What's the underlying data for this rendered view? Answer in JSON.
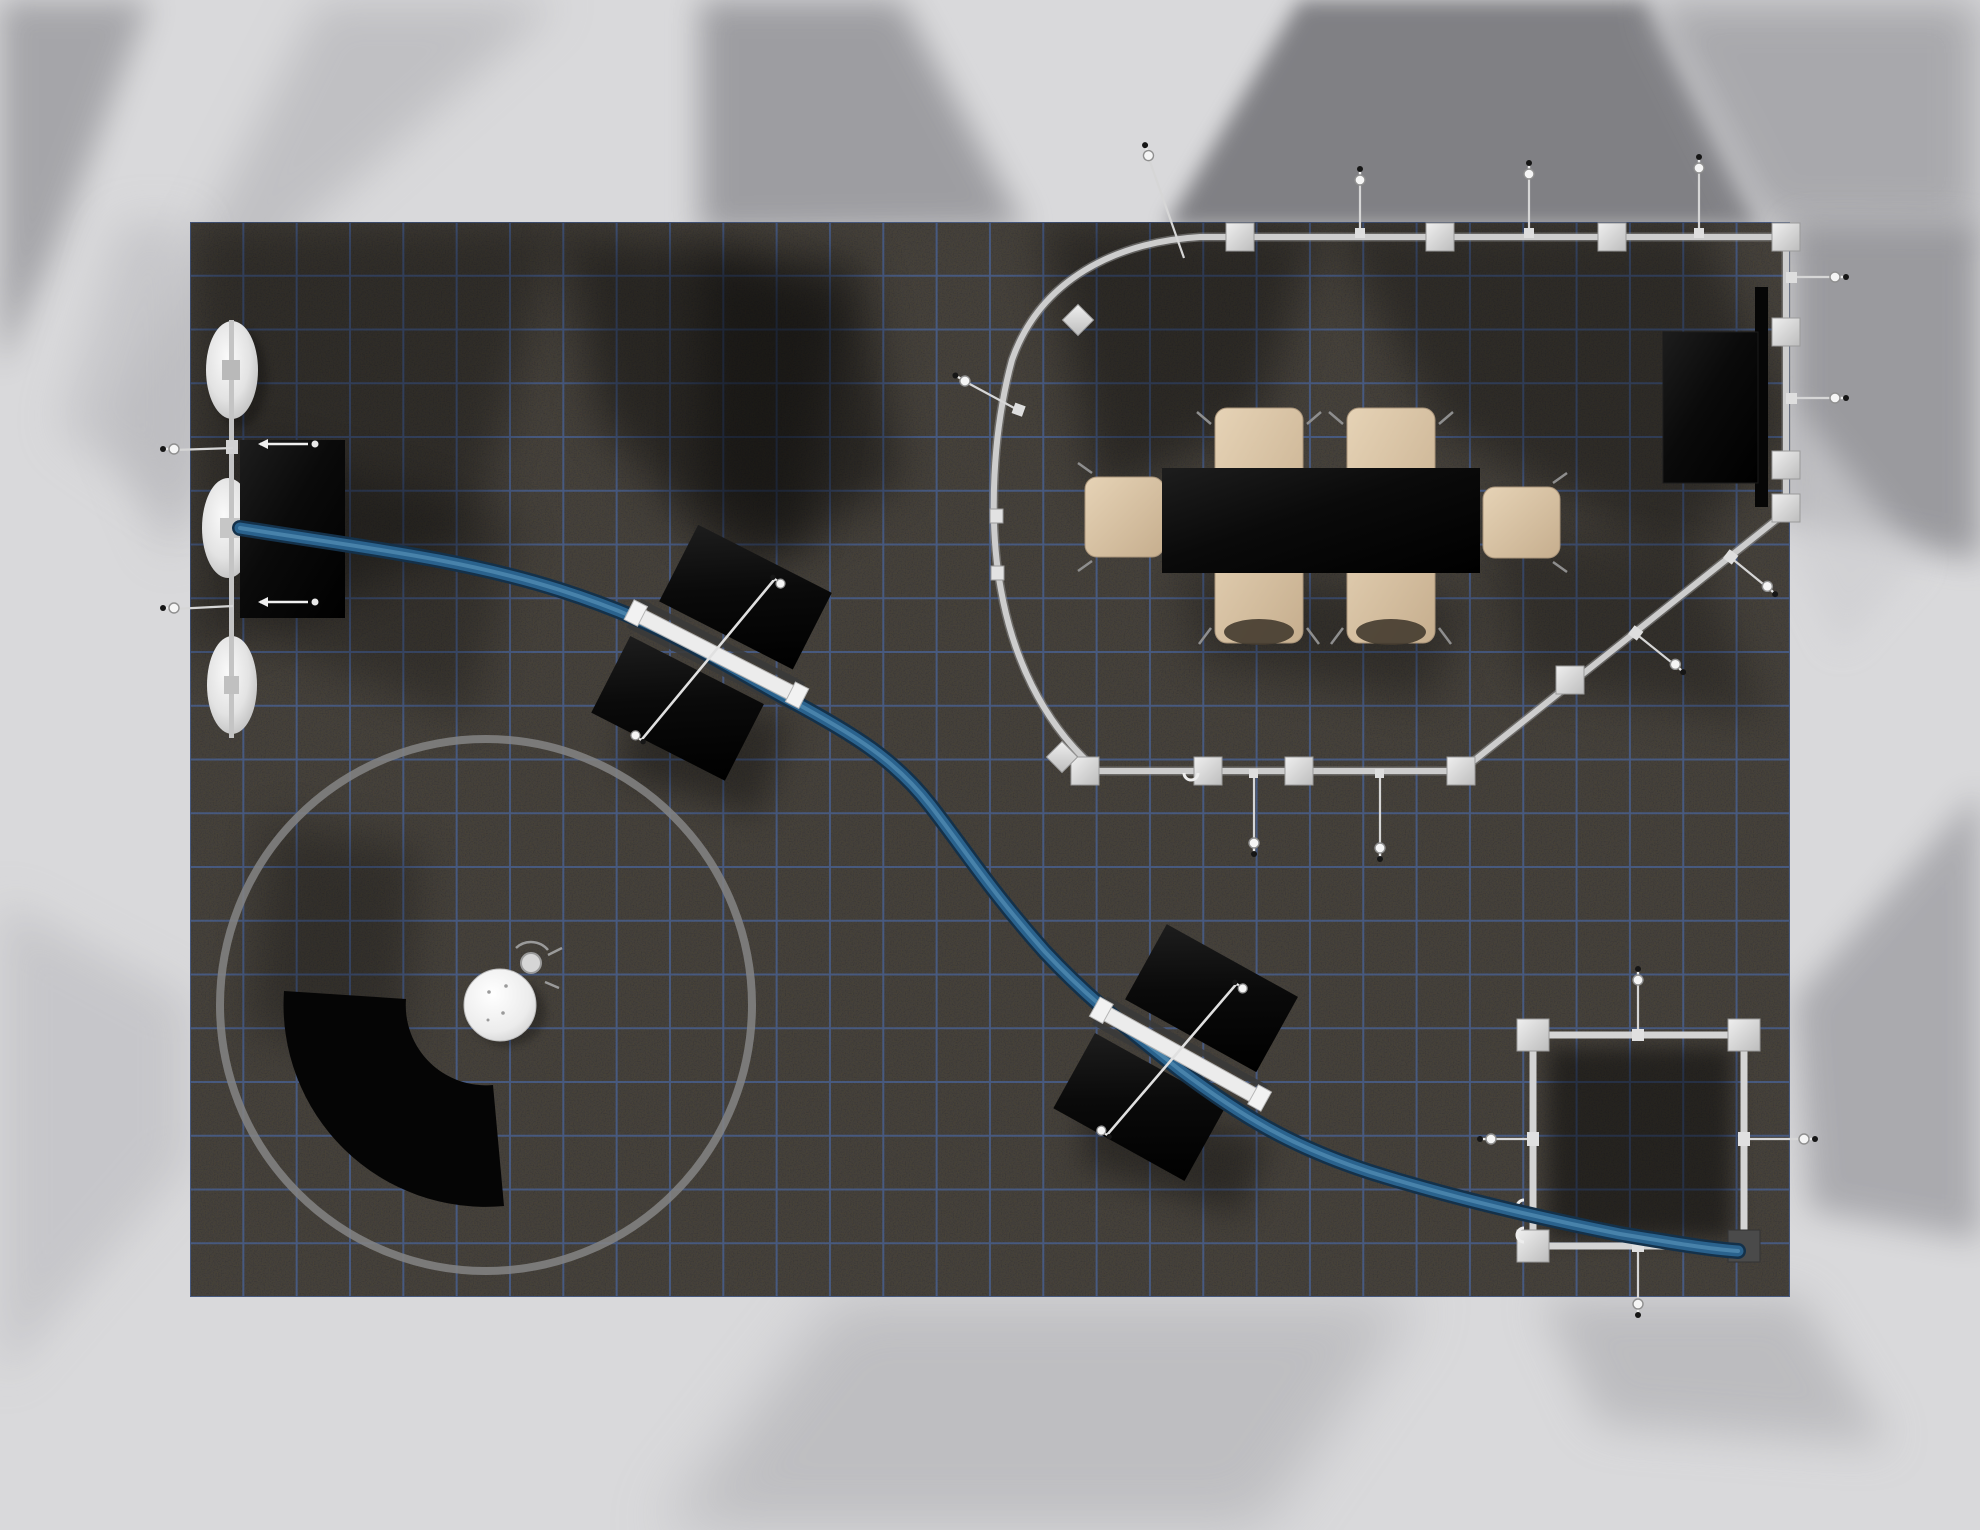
{
  "scene": {
    "label": "exhibit-booth-floorplan-render-top-view",
    "colors": {
      "bg": "#dcdcde",
      "bg_shadow_dark": "#7c7c80",
      "bg_shadow_mid": "#a0a0a4",
      "carpet": "#4e4943",
      "grid_line": "#4a6fb8",
      "frame_tube": "#cccccc",
      "frame_connector": "#d8d8d8",
      "tube_dark": "#14314a",
      "tube_mid": "#2a628d",
      "tube_light": "#4b86ad",
      "panel_black": "#0a0a0a",
      "chair_beige": "#d8c3a5",
      "disc_white": "#f2f2f2",
      "ring_gray": "#858585",
      "table_black": "#0d0d0d"
    },
    "objects": {
      "carpet": {
        "label": "dark booth carpet with blue layout grid"
      },
      "disc_tower": {
        "label": "three stacked white disc canopies on pole"
      },
      "graphic_panel": {
        "label": "black rectangular graphic panel"
      },
      "serpentine_tube": {
        "label": "blue serpentine tube running across booth"
      },
      "workstation_1": {
        "label": "angled double black panel workstation"
      },
      "workstation_2": {
        "label": "angled double black panel workstation"
      },
      "circle_rug": {
        "label": "large gray circle outline zone"
      },
      "fan_counter": {
        "label": "black quarter-arc curved counter"
      },
      "round_table": {
        "label": "small round white table with stool"
      },
      "conference_frame": {
        "label": "curved perimeter frame around meeting area"
      },
      "conference_table": {
        "label": "black rectangular conference table"
      },
      "chairs": {
        "label": "six beige conference chairs",
        "count": 6
      },
      "tv_screen": {
        "label": "wall mounted flat screen"
      },
      "square_frame": {
        "label": "square hanging frame structure"
      },
      "anchors": {
        "label": "cable stay anchor bolts"
      }
    }
  }
}
